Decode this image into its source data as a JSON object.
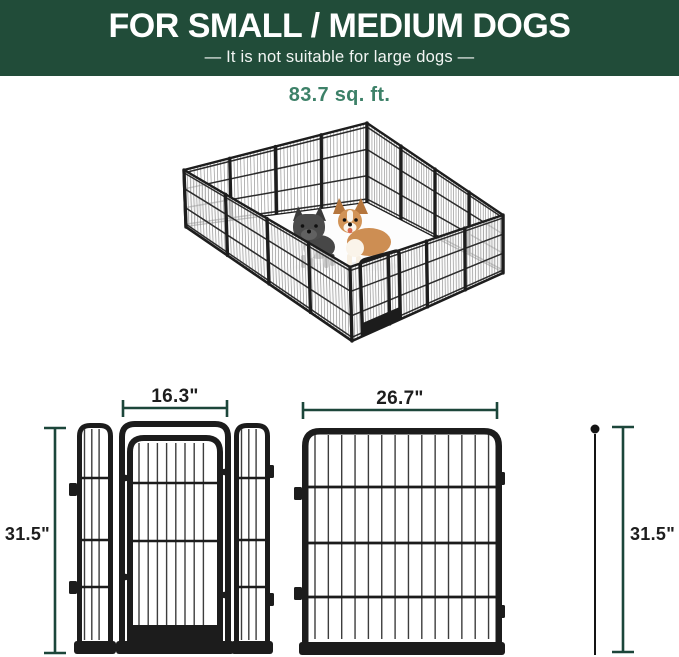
{
  "header": {
    "title": "FOR SMALL / MEDIUM DOGS",
    "subtitle": "—  It is not suitable for large dogs  —"
  },
  "pen": {
    "area_label": "83.7 sq. ft.",
    "illustration": "16-panel metal dog playpen, isometric view, with french bulldog and corgi inside"
  },
  "dimensions": {
    "door_panel_width": "16.3\"",
    "large_panel_width": "26.7\"",
    "height_left": "31.5\"",
    "height_right": "31.5\""
  },
  "colors": {
    "header_bg": "#214c39",
    "header_text": "#ffffff",
    "area_text": "#3d8168",
    "dimension_line": "#1c463a",
    "panel_frame": "#1c1c1c"
  }
}
